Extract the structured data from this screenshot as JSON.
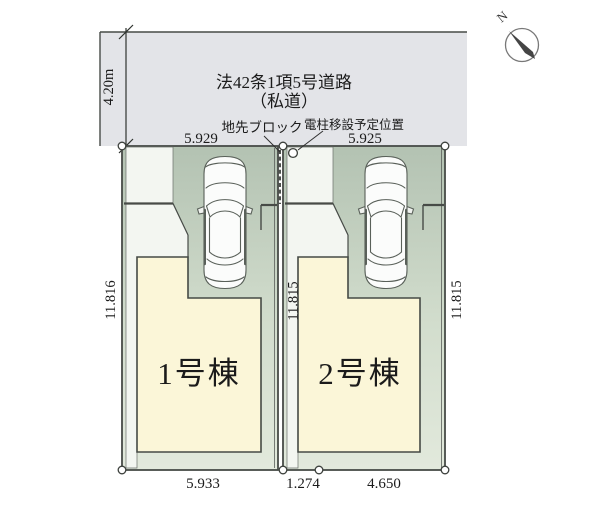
{
  "compass": {
    "north_label": "N"
  },
  "road": {
    "label_line1": "法42条1項5号道路",
    "label_line2": "（私道）",
    "width_dimension": "4.20m"
  },
  "annotations": {
    "frontage_block": "地先ブロック",
    "utility_pole": "電柱移設予定位置"
  },
  "dimensions": {
    "top_left_width": "5.929",
    "top_right_width": "5.925",
    "left_depth": "11.816",
    "middle_depth": "11.815",
    "right_depth": "11.815",
    "bottom": [
      "5.933",
      "1.274",
      "4.650"
    ]
  },
  "lots": [
    {
      "name": "1号棟"
    },
    {
      "name": "2号棟"
    }
  ],
  "icons": [
    "compass-icon",
    "car-top-view-icon",
    "survey-point-icon"
  ],
  "colors": {
    "road_fill": "#e3e4e8",
    "lot_green_top": "#b3c2b2",
    "lot_green_bottom": "#e2e9dc",
    "building_fill": "#fbf6d8",
    "walkway_fill": "#f3f6f1",
    "line": "#474b47"
  }
}
